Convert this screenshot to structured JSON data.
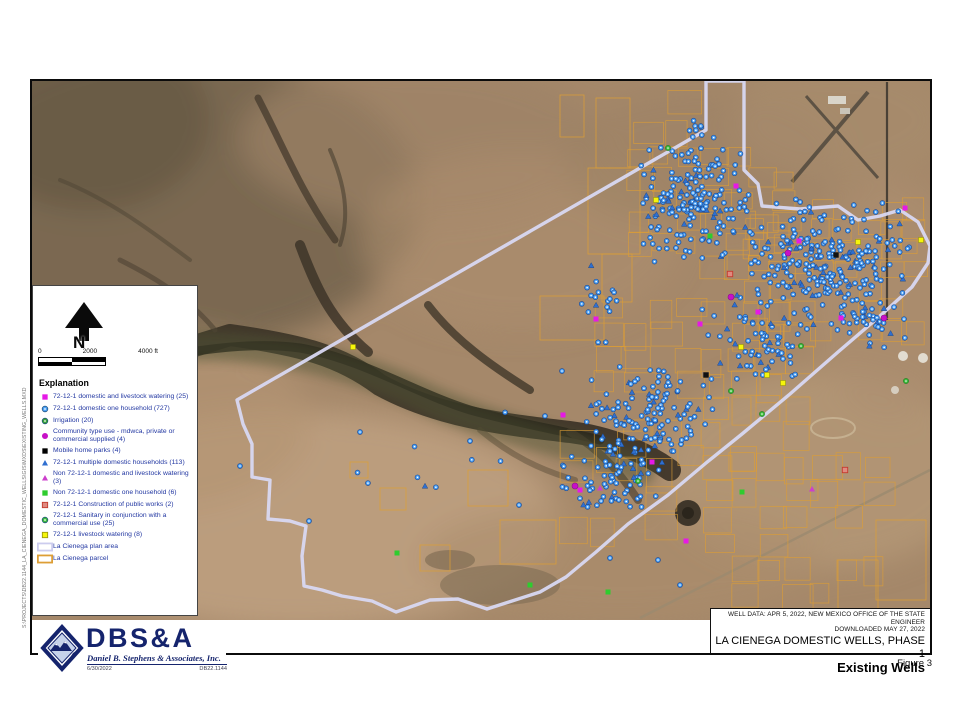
{
  "page": {
    "figure_label": "Figure 3"
  },
  "title_block": {
    "source_line1": "WELL DATA: APR 5, 2022, NEW MEXICO OFFICE OF THE STATE ENGINEER",
    "source_line2": "DOWNLOADED MAY 27, 2022",
    "title": "LA CIENEGA DOMESTIC WELLS, PHASE 1",
    "subtitle": "Existing Wells"
  },
  "logo": {
    "acronym": "DBS&A",
    "company": "Daniel B. Stephens & Associates, Inc.",
    "date": "6/30/2022",
    "project_number": "DB22.1144"
  },
  "north": {
    "label": "N"
  },
  "scale": {
    "ticks": [
      "0",
      "2000",
      "4000 ft"
    ]
  },
  "legend": {
    "heading": "Explanation",
    "items": [
      {
        "type": "square",
        "color": "#e619e6",
        "label": "72-12-1 domestic and livestock watering (25)"
      },
      {
        "type": "dot-circle",
        "color": "#4da2f5",
        "label": "72-12-1 domestic one household (727)"
      },
      {
        "type": "dot-circle",
        "color": "#39a339",
        "label": "Irrigation (20)"
      },
      {
        "type": "circle",
        "color": "#c711c7",
        "label": "Community type use - mdwca, private or commercial supplied (4)"
      },
      {
        "type": "square",
        "color": "#000000",
        "label": "Mobile home parks (4)"
      },
      {
        "type": "triangle",
        "color": "#2f6fd0",
        "label": "72-12-1 multiple domestic households (113)"
      },
      {
        "type": "triangle",
        "color": "#cc3fcc",
        "label": "Non 72-12-1 domestic and livestock watering (3)"
      },
      {
        "type": "square",
        "color": "#2ecc2e",
        "label": "Non 72-12-1 domestic one household (6)"
      },
      {
        "type": "square-outline",
        "color": "#e08a80",
        "border": "#c23b2e",
        "label": "72-12-1 Construction of public works (2)"
      },
      {
        "type": "dot-circle",
        "color": "#3dbb3d",
        "label": "72-12-1 Sanitary in conjunction with a commercial use (25)"
      },
      {
        "type": "square-outline",
        "color": "#f5f50a",
        "border": "#99990a",
        "label": "72-12-1 livestock watering (8)"
      },
      {
        "type": "rect-outline",
        "color": "#ccccee",
        "label": "La Cienega plan area"
      },
      {
        "type": "rect-outline",
        "color": "#dd9e35",
        "label": "La Cienega parcel"
      }
    ]
  },
  "map": {
    "file_path": "S:\\PROJECTS\\DB22.1144_LA_CIENEGA_DOMESTIC_WELLS\\GIS\\MXDS\\EXISTING_WELLS.MXD",
    "colors": {
      "boundary": "#d8d8f2",
      "parcel": "#dd9e35",
      "well_fill": "#4da2f5",
      "well_stroke": "#1b4c9b",
      "triangle": "#2f6fd0"
    },
    "boundary_points": [
      [
        706,
        81
      ],
      [
        706,
        130
      ],
      [
        237,
        400
      ],
      [
        243,
        424
      ],
      [
        252,
        444
      ],
      [
        252,
        477
      ],
      [
        270,
        480
      ],
      [
        268,
        519
      ],
      [
        290,
        521
      ],
      [
        306,
        526
      ],
      [
        302,
        556
      ],
      [
        304,
        586
      ],
      [
        322,
        590
      ],
      [
        342,
        596
      ],
      [
        372,
        601
      ],
      [
        396,
        612
      ],
      [
        430,
        600
      ],
      [
        458,
        599
      ],
      [
        487,
        609
      ],
      [
        512,
        601
      ],
      [
        540,
        592
      ],
      [
        566,
        577
      ],
      [
        596,
        552
      ],
      [
        628,
        524
      ],
      [
        668,
        495
      ],
      [
        706,
        463
      ],
      [
        742,
        434
      ],
      [
        790,
        394
      ],
      [
        838,
        352
      ],
      [
        880,
        316
      ],
      [
        912,
        287
      ],
      [
        928,
        263
      ],
      [
        930,
        246
      ],
      [
        918,
        222
      ],
      [
        900,
        210
      ],
      [
        880,
        216
      ],
      [
        858,
        220
      ],
      [
        838,
        206
      ],
      [
        800,
        209
      ],
      [
        762,
        206
      ],
      [
        758,
        184
      ],
      [
        744,
        170
      ],
      [
        744,
        81
      ]
    ],
    "parcel_zones": [
      {
        "x": 628,
        "y": 148,
        "w": 170,
        "h": 130,
        "cols": 7,
        "rows": 6,
        "skip": 0.35
      },
      {
        "x": 745,
        "y": 200,
        "w": 180,
        "h": 140,
        "cols": 8,
        "rows": 7,
        "skip": 0.3
      },
      {
        "x": 596,
        "y": 300,
        "w": 215,
        "h": 170,
        "cols": 8,
        "rows": 7,
        "skip": 0.42
      },
      {
        "x": 705,
        "y": 455,
        "w": 185,
        "h": 155,
        "cols": 7,
        "rows": 6,
        "skip": 0.42
      },
      {
        "x": 560,
        "y": 430,
        "w": 115,
        "h": 115,
        "cols": 4,
        "rows": 4,
        "skip": 0.4
      },
      {
        "x": 636,
        "y": 92,
        "w": 60,
        "h": 58,
        "cols": 2,
        "rows": 2,
        "skip": 0.2
      }
    ],
    "parcel_rects": [
      [
        596,
        98,
        34,
        70
      ],
      [
        588,
        168,
        52,
        86
      ],
      [
        602,
        254,
        30,
        48
      ],
      [
        540,
        296,
        64,
        44
      ],
      [
        468,
        470,
        40,
        36
      ],
      [
        500,
        520,
        56,
        44
      ],
      [
        420,
        545,
        30,
        26
      ],
      [
        380,
        488,
        26,
        22
      ],
      [
        350,
        462,
        18,
        16
      ],
      [
        560,
        95,
        24,
        42
      ],
      [
        876,
        520,
        50,
        80
      ],
      [
        838,
        560,
        40,
        50
      ]
    ],
    "well_clusters": [
      {
        "cx": 693,
        "cy": 205,
        "rx": 58,
        "ry": 62,
        "n": 160
      },
      {
        "cx": 825,
        "cy": 262,
        "rx": 95,
        "ry": 68,
        "n": 250
      },
      {
        "cx": 760,
        "cy": 345,
        "rx": 70,
        "ry": 45,
        "n": 70
      },
      {
        "cx": 648,
        "cy": 415,
        "rx": 75,
        "ry": 55,
        "n": 130
      },
      {
        "cx": 612,
        "cy": 478,
        "rx": 55,
        "ry": 40,
        "n": 70
      },
      {
        "cx": 598,
        "cy": 300,
        "rx": 25,
        "ry": 45,
        "n": 18
      },
      {
        "cx": 870,
        "cy": 320,
        "rx": 45,
        "ry": 30,
        "n": 40
      },
      {
        "cx": 700,
        "cy": 150,
        "rx": 30,
        "ry": 35,
        "n": 25
      },
      {
        "cx": 420,
        "cy": 470,
        "rx": 150,
        "ry": 70,
        "n": 8
      }
    ],
    "special_markers": [
      {
        "t": "ms",
        "x": 736,
        "y": 186
      },
      {
        "t": "ms",
        "x": 799,
        "y": 241
      },
      {
        "t": "ms",
        "x": 758,
        "y": 312
      },
      {
        "t": "ms",
        "x": 700,
        "y": 324
      },
      {
        "t": "ms",
        "x": 596,
        "y": 319
      },
      {
        "t": "ms",
        "x": 652,
        "y": 462
      },
      {
        "t": "ms",
        "x": 686,
        "y": 541
      },
      {
        "t": "ms",
        "x": 563,
        "y": 415
      },
      {
        "t": "ms",
        "x": 580,
        "y": 490
      },
      {
        "t": "ms",
        "x": 905,
        "y": 208
      },
      {
        "t": "ms",
        "x": 841,
        "y": 318
      },
      {
        "t": "mc",
        "x": 731,
        "y": 297
      },
      {
        "t": "mc",
        "x": 788,
        "y": 253
      },
      {
        "t": "mc",
        "x": 884,
        "y": 318
      },
      {
        "t": "mc",
        "x": 575,
        "y": 486
      },
      {
        "t": "ys",
        "x": 353,
        "y": 347
      },
      {
        "t": "ys",
        "x": 656,
        "y": 200
      },
      {
        "t": "ys",
        "x": 741,
        "y": 347
      },
      {
        "t": "ys",
        "x": 767,
        "y": 375
      },
      {
        "t": "ys",
        "x": 858,
        "y": 242
      },
      {
        "t": "ys",
        "x": 921,
        "y": 240
      },
      {
        "t": "ys",
        "x": 783,
        "y": 383
      },
      {
        "t": "gs",
        "x": 397,
        "y": 553
      },
      {
        "t": "gs",
        "x": 608,
        "y": 592
      },
      {
        "t": "gs",
        "x": 742,
        "y": 492
      },
      {
        "t": "gs",
        "x": 710,
        "y": 236
      },
      {
        "t": "gs",
        "x": 530,
        "y": 585
      },
      {
        "t": "gc",
        "x": 668,
        "y": 148
      },
      {
        "t": "gc",
        "x": 801,
        "y": 346
      },
      {
        "t": "gc",
        "x": 906,
        "y": 381
      },
      {
        "t": "gc",
        "x": 762,
        "y": 414
      },
      {
        "t": "gc",
        "x": 731,
        "y": 391
      },
      {
        "t": "gc",
        "x": 638,
        "y": 481
      },
      {
        "t": "mt",
        "x": 600,
        "y": 488
      },
      {
        "t": "mt",
        "x": 812,
        "y": 489
      },
      {
        "t": "rs",
        "x": 730,
        "y": 274
      },
      {
        "t": "rs",
        "x": 845,
        "y": 470
      },
      {
        "t": "bk",
        "x": 836,
        "y": 255
      },
      {
        "t": "bk",
        "x": 706,
        "y": 375
      },
      {
        "t": "bd",
        "x": 240,
        "y": 466
      },
      {
        "t": "bd",
        "x": 309,
        "y": 521
      },
      {
        "t": "bd",
        "x": 519,
        "y": 505
      },
      {
        "t": "bd",
        "x": 470,
        "y": 441
      },
      {
        "t": "bd",
        "x": 545,
        "y": 416
      },
      {
        "t": "bd",
        "x": 562,
        "y": 371
      },
      {
        "t": "bd",
        "x": 360,
        "y": 432
      },
      {
        "t": "bd",
        "x": 658,
        "y": 560
      },
      {
        "t": "bd",
        "x": 610,
        "y": 558
      },
      {
        "t": "bd",
        "x": 680,
        "y": 585
      },
      {
        "t": "bt",
        "x": 425,
        "y": 486
      }
    ]
  }
}
